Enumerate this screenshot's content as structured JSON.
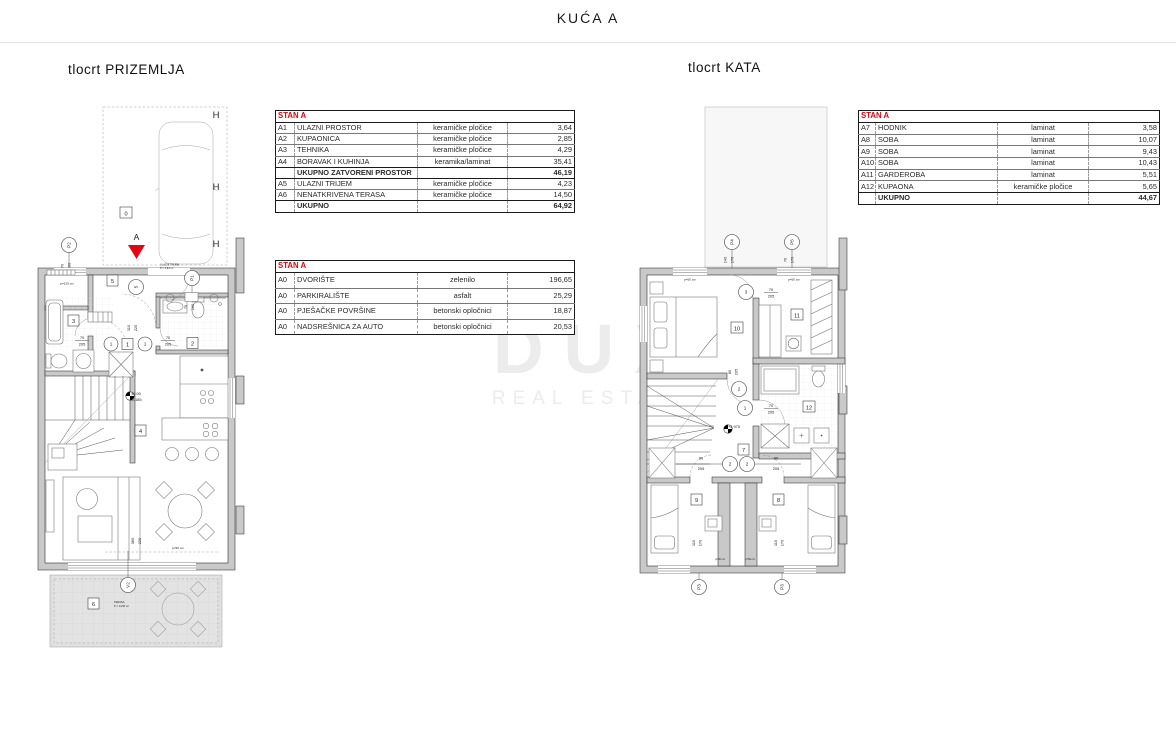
{
  "page": {
    "title": "KUĆA A"
  },
  "watermark": {
    "line1": "DUX",
    "line2": "REAL ESTATE"
  },
  "colors": {
    "accent_red": "#e30613",
    "table_header_red": "#d10a11",
    "wall_gray": "#c9c9c9",
    "watermark_gray": "#ececec"
  },
  "gf": {
    "heading": "tlocrt PRIZEMLJA",
    "carport_label": "0",
    "h": "H",
    "section": "A",
    "p1": "P1",
    "p2": "P2",
    "v2": "V2",
    "box5": "5",
    "circle5": "5",
    "box1": "1",
    "circle1": "1",
    "box2": "2",
    "box3": "3",
    "box4": "4",
    "box6": "6",
    "d70": "70",
    "d100": "100",
    "d110": "110",
    "d205": "205",
    "d220": "220",
    "d360": "360",
    "p120": "p=120 cm",
    "p90": "p=90 cm",
    "lvl0": "±0.00",
    "lvl1": "-0,185",
    "trijem1": "ULAZNI TRIJEM",
    "trijem2": "P = 4,94 m²",
    "ter1": "TERASA",
    "ter2": "P = 14,50 m²"
  },
  "uf": {
    "heading": "tlocrt KATA",
    "p3": "P3",
    "p4": "P4",
    "p5": "P5",
    "c1": "1",
    "c2": "2",
    "c3": "3",
    "b7": "7",
    "b8": "8",
    "b9": "9",
    "b10": "10",
    "b11": "11",
    "b12": "12",
    "d70": "70",
    "d80": "80",
    "d110": "110",
    "d140": "140",
    "d170": "170",
    "d205": "205",
    "p50": "p=50 cm",
    "lvl": "+2,975"
  },
  "tables": {
    "prizemlje": {
      "header": "STAN A",
      "rows": [
        {
          "code": "A1",
          "name": "ULAZNI PROSTOR",
          "material": "keramičke pločice",
          "area": "3,64",
          "bold": false
        },
        {
          "code": "A2",
          "name": "KUPAONICA",
          "material": "keramičke pločice",
          "area": "2,85",
          "bold": false
        },
        {
          "code": "A3",
          "name": "TEHNIKA",
          "material": "keramičke pločice",
          "area": "4,29",
          "bold": false
        },
        {
          "code": "A4",
          "name": "BORAVAK I KUHINJA",
          "material": "keramika/laminat",
          "area": "35,41",
          "bold": false
        },
        {
          "code": "",
          "name": "UKUPNO ZATVORENI PROSTOR",
          "material": "",
          "area": "46,19",
          "bold": true
        },
        {
          "code": "A5",
          "name": "ULAZNI TRIJEM",
          "material": "keramičke pločice",
          "area": "4,23",
          "bold": false
        },
        {
          "code": "A6",
          "name": "NENATKRIVENA TERASA",
          "material": "keramičke pločice",
          "area": "14,50",
          "bold": false
        },
        {
          "code": "",
          "name": "UKUPNO",
          "material": "",
          "area": "64,92",
          "bold": true
        }
      ]
    },
    "okolis": {
      "header": "STAN A",
      "rows": [
        {
          "code": "A0",
          "name": "DVORIŠTE",
          "material": "zelenilo",
          "area": "196,65",
          "bold": false
        },
        {
          "code": "A0",
          "name": "PARKIRALIŠTE",
          "material": "asfalt",
          "area": "25,29",
          "bold": false
        },
        {
          "code": "A0",
          "name": "PJEŠAČKE POVRŠINE",
          "material": "betonski opločnici",
          "area": "18,87",
          "bold": false
        },
        {
          "code": "A0",
          "name": "NADSREŠNICA ZA AUTO",
          "material": "betonski opločnici",
          "area": "20,53",
          "bold": false
        }
      ]
    },
    "kat": {
      "header": "STAN A",
      "rows": [
        {
          "code": "A7",
          "name": "HODNIK",
          "material": "laminat",
          "area": "3,58",
          "bold": false
        },
        {
          "code": "A8",
          "name": "SOBA",
          "material": "laminat",
          "area": "10,07",
          "bold": false
        },
        {
          "code": "A9",
          "name": "SOBA",
          "material": "laminat",
          "area": "9,43",
          "bold": false
        },
        {
          "code": "A10",
          "name": "SOBA",
          "material": "laminat",
          "area": "10,43",
          "bold": false
        },
        {
          "code": "A11",
          "name": "GARDEROBA",
          "material": "laminat",
          "area": "5,51",
          "bold": false
        },
        {
          "code": "A12",
          "name": "KUPAONA",
          "material": "keramičke pločice",
          "area": "5,65",
          "bold": false
        },
        {
          "code": "",
          "name": "UKUPNO",
          "material": "",
          "area": "44,67",
          "bold": true
        }
      ]
    }
  }
}
